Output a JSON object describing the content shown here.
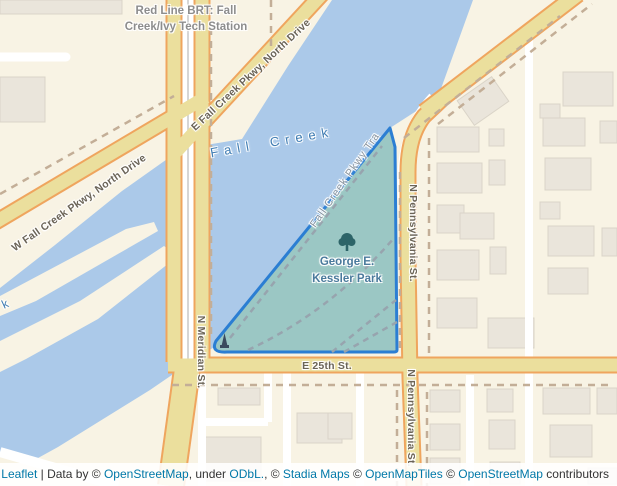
{
  "labels": {
    "station_line1": "Red Line BRT: Fall",
    "station_line2": "Creek/Ivy Tech Station",
    "water": "Fall Creek",
    "water_partial": "k",
    "park_line1": "George E.",
    "park_line2": "Kessler Park",
    "trail": "Fall Creek Pkwy Tra",
    "streets": {
      "w_parkway": "W Fall Creek Pkwy, North Drive",
      "e_parkway": "E Fall Creek Pkwy, North Drive",
      "meridian": "N Meridian St.",
      "pennsylvania": "N Pennsylvania St.",
      "pennsylvania_south": "N Pennsylvania St.",
      "e_25th": "E 25th St."
    }
  },
  "attribution": {
    "leaflet": "Leaflet",
    "separator": " | ",
    "data_by": "Data by © ",
    "osm": "OpenStreetMap",
    "under": ", under ",
    "odbl": "ODbL.",
    "comma_c": ", © ",
    "stadia": "Stadia Maps",
    "c1": " © ",
    "openmaptiles": "OpenMapTiles",
    "c2": " © ",
    "osm2": "OpenStreetMap",
    "contributors": " contributors"
  },
  "colors": {
    "land": "#f8f3e4",
    "water": "#abc9e9",
    "park_fill": "#9bc7c4",
    "park_border": "#2b7ed3",
    "road_fill": "#ebdf9d",
    "road_casing": "#efa55e",
    "minor_road": "#ffffff",
    "building": "#eae5db",
    "trail_dash": "#c3ae97",
    "park_path_dash": "#97a4ae",
    "street_label": "#6b6457",
    "water_label": "#3f7cb2",
    "park_label": "#4a7a9c",
    "station_label": "#8d8d8d",
    "attribution_link": "#0078a8",
    "attribution_text": "#333333"
  },
  "icons": {
    "tree": "tree-icon",
    "monument": "monument-icon"
  }
}
